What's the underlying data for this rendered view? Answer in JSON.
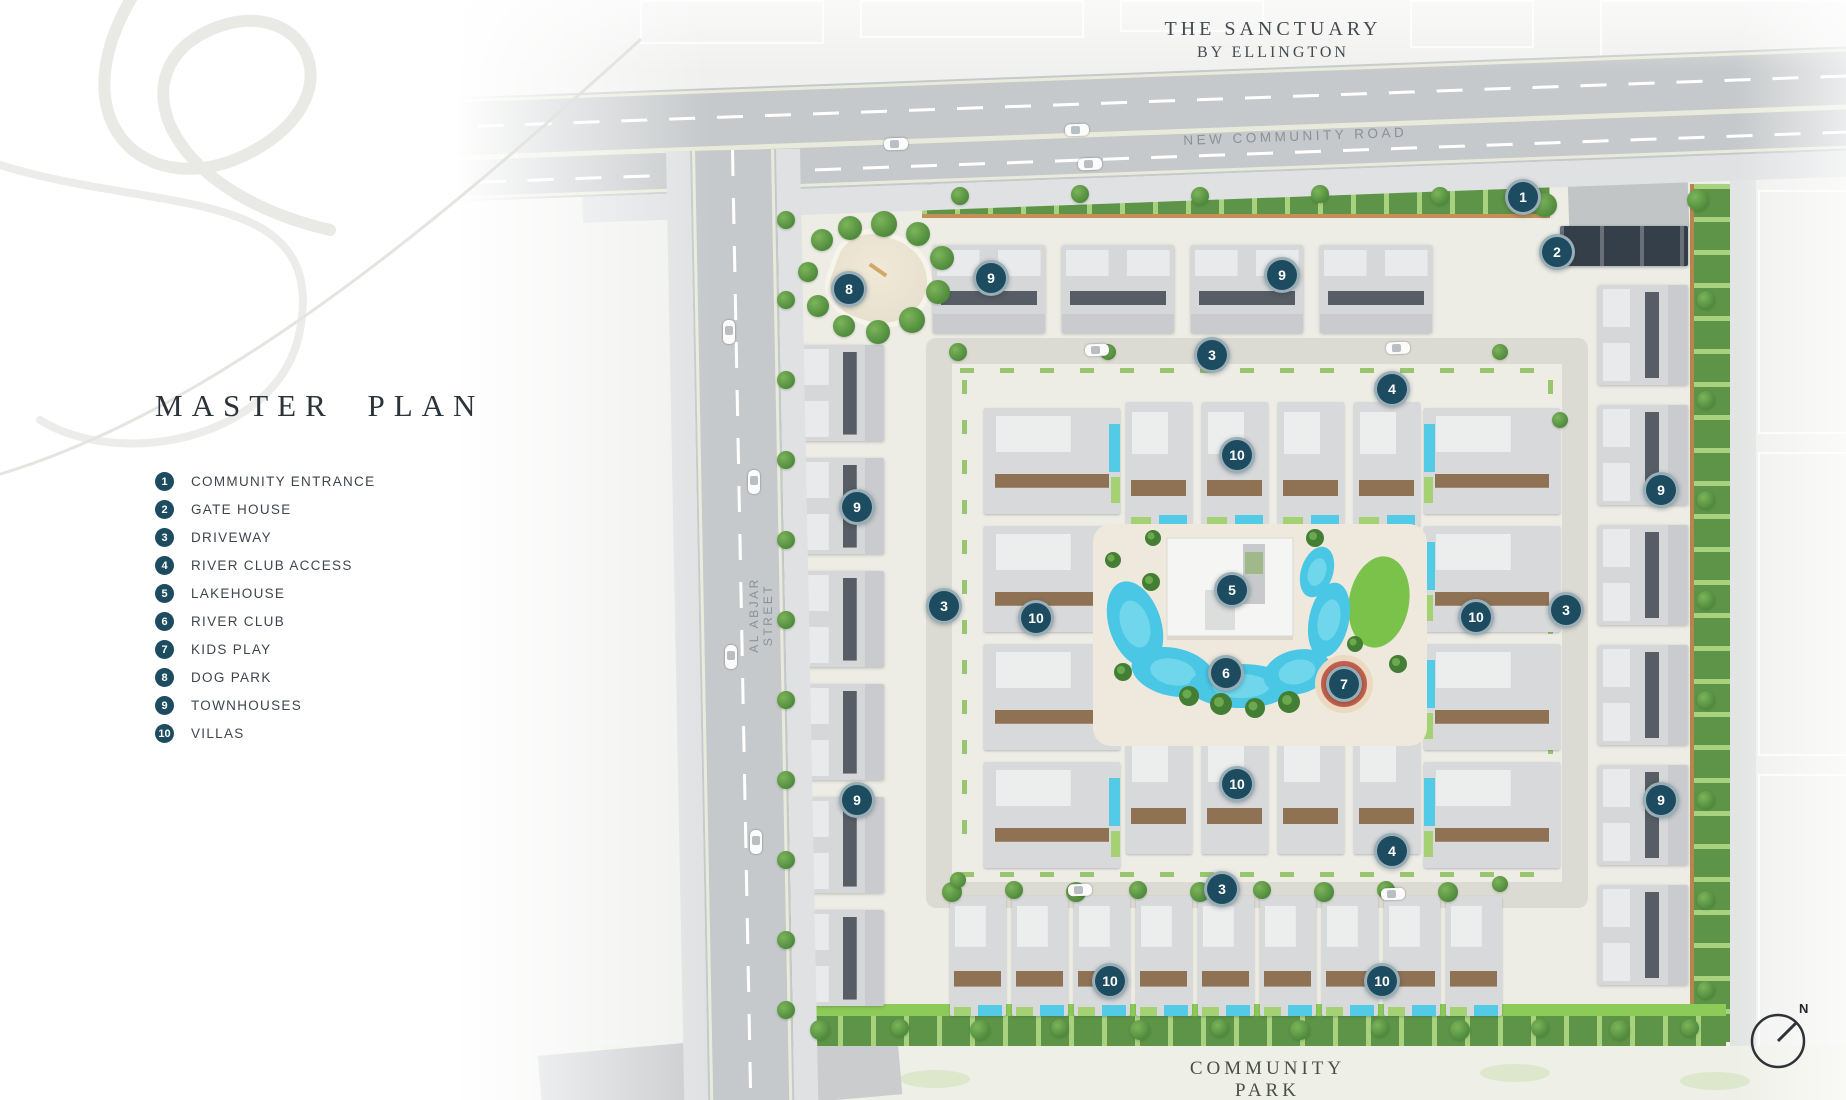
{
  "header": {
    "title": "THE SANCTUARY",
    "subtitle": "BY ELLINGTON"
  },
  "panel": {
    "heading": "MASTER PLAN"
  },
  "legend": [
    {
      "num": "1",
      "label": "COMMUNITY ENTRANCE"
    },
    {
      "num": "2",
      "label": "GATE HOUSE"
    },
    {
      "num": "3",
      "label": "DRIVEWAY"
    },
    {
      "num": "4",
      "label": "RIVER CLUB ACCESS"
    },
    {
      "num": "5",
      "label": "LAKEHOUSE"
    },
    {
      "num": "6",
      "label": "RIVER CLUB"
    },
    {
      "num": "7",
      "label": "KIDS PLAY"
    },
    {
      "num": "8",
      "label": "DOG PARK"
    },
    {
      "num": "9",
      "label": "TOWNHOUSES"
    },
    {
      "num": "10",
      "label": "VILLAS"
    }
  ],
  "roads": {
    "top": "NEW COMMUNITY ROAD",
    "left": "AL ABJAR STREET"
  },
  "park": {
    "label": "COMMUNITY PARK"
  },
  "compass": {
    "label": "N"
  },
  "markers": [
    {
      "num": "1",
      "label": "COMMUNITY ENTRANCE",
      "x": 1523,
      "y": 197
    },
    {
      "num": "2",
      "label": "GATE HOUSE",
      "x": 1557,
      "y": 252
    },
    {
      "num": "8",
      "label": "DOG PARK",
      "x": 849,
      "y": 289
    },
    {
      "num": "9",
      "label": "TOWNHOUSES",
      "x": 991,
      "y": 278
    },
    {
      "num": "9",
      "label": "TOWNHOUSES",
      "x": 1282,
      "y": 275
    },
    {
      "num": "3",
      "label": "DRIVEWAY",
      "x": 1212,
      "y": 355
    },
    {
      "num": "4",
      "label": "RIVER CLUB ACCESS",
      "x": 1392,
      "y": 389
    },
    {
      "num": "10",
      "label": "VILLAS",
      "x": 1237,
      "y": 455
    },
    {
      "num": "9",
      "label": "TOWNHOUSES",
      "x": 1661,
      "y": 490
    },
    {
      "num": "9",
      "label": "TOWNHOUSES",
      "x": 857,
      "y": 507
    },
    {
      "num": "3",
      "label": "DRIVEWAY",
      "x": 944,
      "y": 606
    },
    {
      "num": "10",
      "label": "VILLAS",
      "x": 1036,
      "y": 618
    },
    {
      "num": "5",
      "label": "LAKEHOUSE",
      "x": 1232,
      "y": 590
    },
    {
      "num": "10",
      "label": "VILLAS",
      "x": 1476,
      "y": 617
    },
    {
      "num": "3",
      "label": "DRIVEWAY",
      "x": 1566,
      "y": 610
    },
    {
      "num": "6",
      "label": "RIVER CLUB",
      "x": 1226,
      "y": 673
    },
    {
      "num": "7",
      "label": "KIDS PLAY",
      "x": 1344,
      "y": 684
    },
    {
      "num": "9",
      "label": "TOWNHOUSES",
      "x": 857,
      "y": 800
    },
    {
      "num": "10",
      "label": "VILLAS",
      "x": 1237,
      "y": 784
    },
    {
      "num": "9",
      "label": "TOWNHOUSES",
      "x": 1661,
      "y": 800
    },
    {
      "num": "4",
      "label": "RIVER CLUB ACCESS",
      "x": 1392,
      "y": 851
    },
    {
      "num": "3",
      "label": "DRIVEWAY",
      "x": 1222,
      "y": 889
    },
    {
      "num": "10",
      "label": "VILLAS",
      "x": 1110,
      "y": 981
    },
    {
      "num": "10",
      "label": "VILLAS",
      "x": 1382,
      "y": 981
    }
  ],
  "colors": {
    "marker": "#1d4c60",
    "water": "#49c7e4",
    "lawn": "#7ac24a",
    "hedge": "#5d9447",
    "road_label": "#8b9196"
  }
}
